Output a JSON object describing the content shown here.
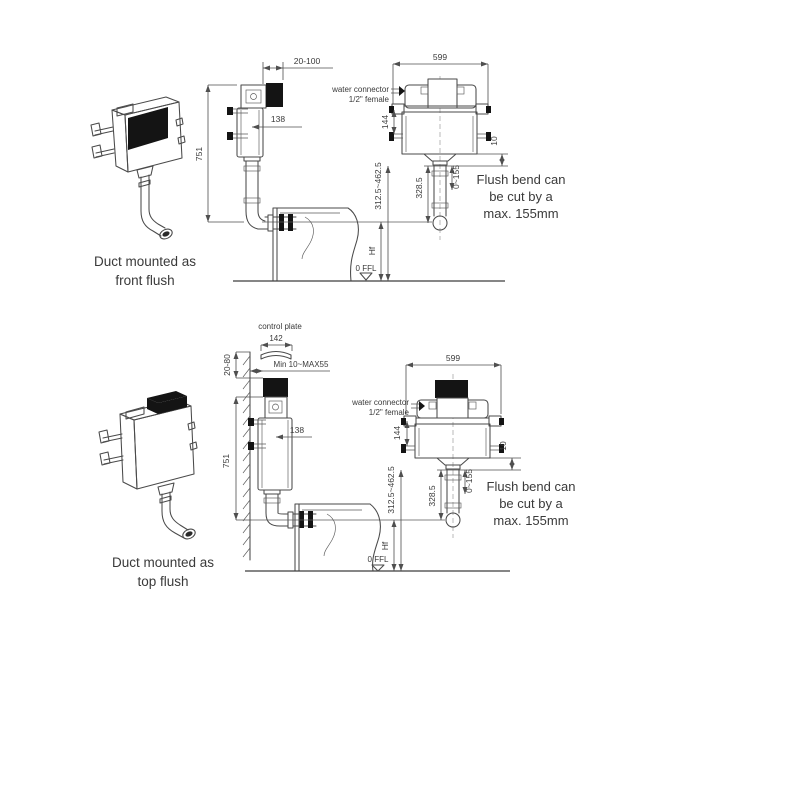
{
  "front_flush": {
    "caption": [
      "Duct mounted as",
      "front flush"
    ],
    "side_view": {
      "plate_depth_range": "20-100",
      "install_height": "751",
      "pipe_offset": "138",
      "ffl_label": "0 FFL"
    },
    "front_view": {
      "frame_width": "599",
      "bracket_spacing": "144",
      "outlet_gap": "10",
      "outlet_height_range": "312.5~462.5",
      "flush_bend_length": "328.5",
      "cut_range": "0~155",
      "flush_height_label": "Hf",
      "water_connector": [
        "water connector",
        "1/2\" female"
      ],
      "flush_bend_note": [
        "Flush bend can",
        "be cut by a",
        "max. 155mm"
      ]
    }
  },
  "top_flush": {
    "caption": [
      "Duct mounted as",
      "top flush"
    ],
    "side_view": {
      "control_plate_label": "control plate",
      "control_plate_width": "142",
      "recess_depth_range": "20-80",
      "finish_thickness_range": "Min 10~MAX55",
      "install_height": "751",
      "pipe_offset": "138",
      "ffl_label": "0 FFL"
    },
    "front_view": {
      "frame_width": "599",
      "bracket_spacing": "144",
      "outlet_gap": "10",
      "outlet_height_range": "312.5~462.5",
      "flush_bend_length": "328.5",
      "cut_range": "0~155",
      "flush_height_label": "Hf",
      "water_connector": [
        "water connector",
        "1/2\" female"
      ],
      "flush_bend_note": [
        "Flush bend can",
        "be cut by a",
        "max. 155mm"
      ]
    }
  }
}
